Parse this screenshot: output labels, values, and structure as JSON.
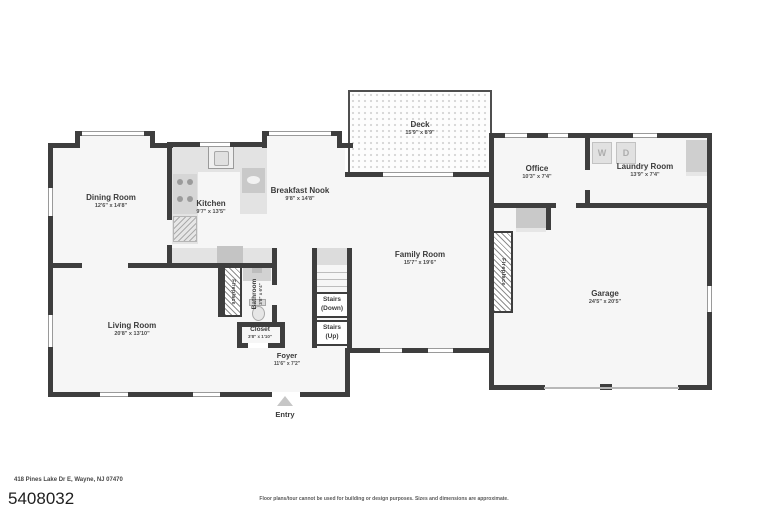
{
  "colors": {
    "wall": "#3e3e3e",
    "room_fill": "#f6f6f6",
    "counter": "#e3e3e3",
    "appliance": "#c9c9c9",
    "label_text": "#3b3b3b"
  },
  "rooms": {
    "dining": {
      "name": "Dining Room",
      "dims": "12'6\" x 14'8\""
    },
    "kitchen": {
      "name": "Kitchen",
      "dims": "9'7\" x 13'5\""
    },
    "breakfast": {
      "name": "Breakfast Nook",
      "dims": "9'8\" x 14'8\""
    },
    "deck": {
      "name": "Deck",
      "dims": "15'9\" x 8'9\""
    },
    "office": {
      "name": "Office",
      "dims": "10'3\" x 7'4\""
    },
    "laundry": {
      "name": "Laundry Room",
      "dims": "13'9\" x 7'4\""
    },
    "family": {
      "name": "Family Room",
      "dims": "15'7\" x 19'6\""
    },
    "garage": {
      "name": "Garage",
      "dims": "24'5\" x 20'5\""
    },
    "living": {
      "name": "Living Room",
      "dims": "20'8\" x 13'10\""
    },
    "bathroom": {
      "name": "Bathroom",
      "dims": "3'8\" x 6'4\""
    },
    "closet": {
      "name": "Closet",
      "dims": "3'8\" x 1'10\""
    },
    "foyer": {
      "name": "Foyer",
      "dims": "11'6\" x 7'2\""
    }
  },
  "labels": {
    "fireplace_left": "Fireplace",
    "fireplace_right": "Fireplace",
    "stairs_down": "Stairs (Down)",
    "stairs_up": "Stairs (Up)",
    "entry": "Entry",
    "washer": "W",
    "dryer": "D"
  },
  "footer": {
    "address": "418 Pines Lake Dr E, Wayne, NJ 07470",
    "listing_number": "5408032",
    "disclaimer": "Floor plans/tour cannot be used for building or design purposes. Sizes and dimensions are approximate."
  }
}
